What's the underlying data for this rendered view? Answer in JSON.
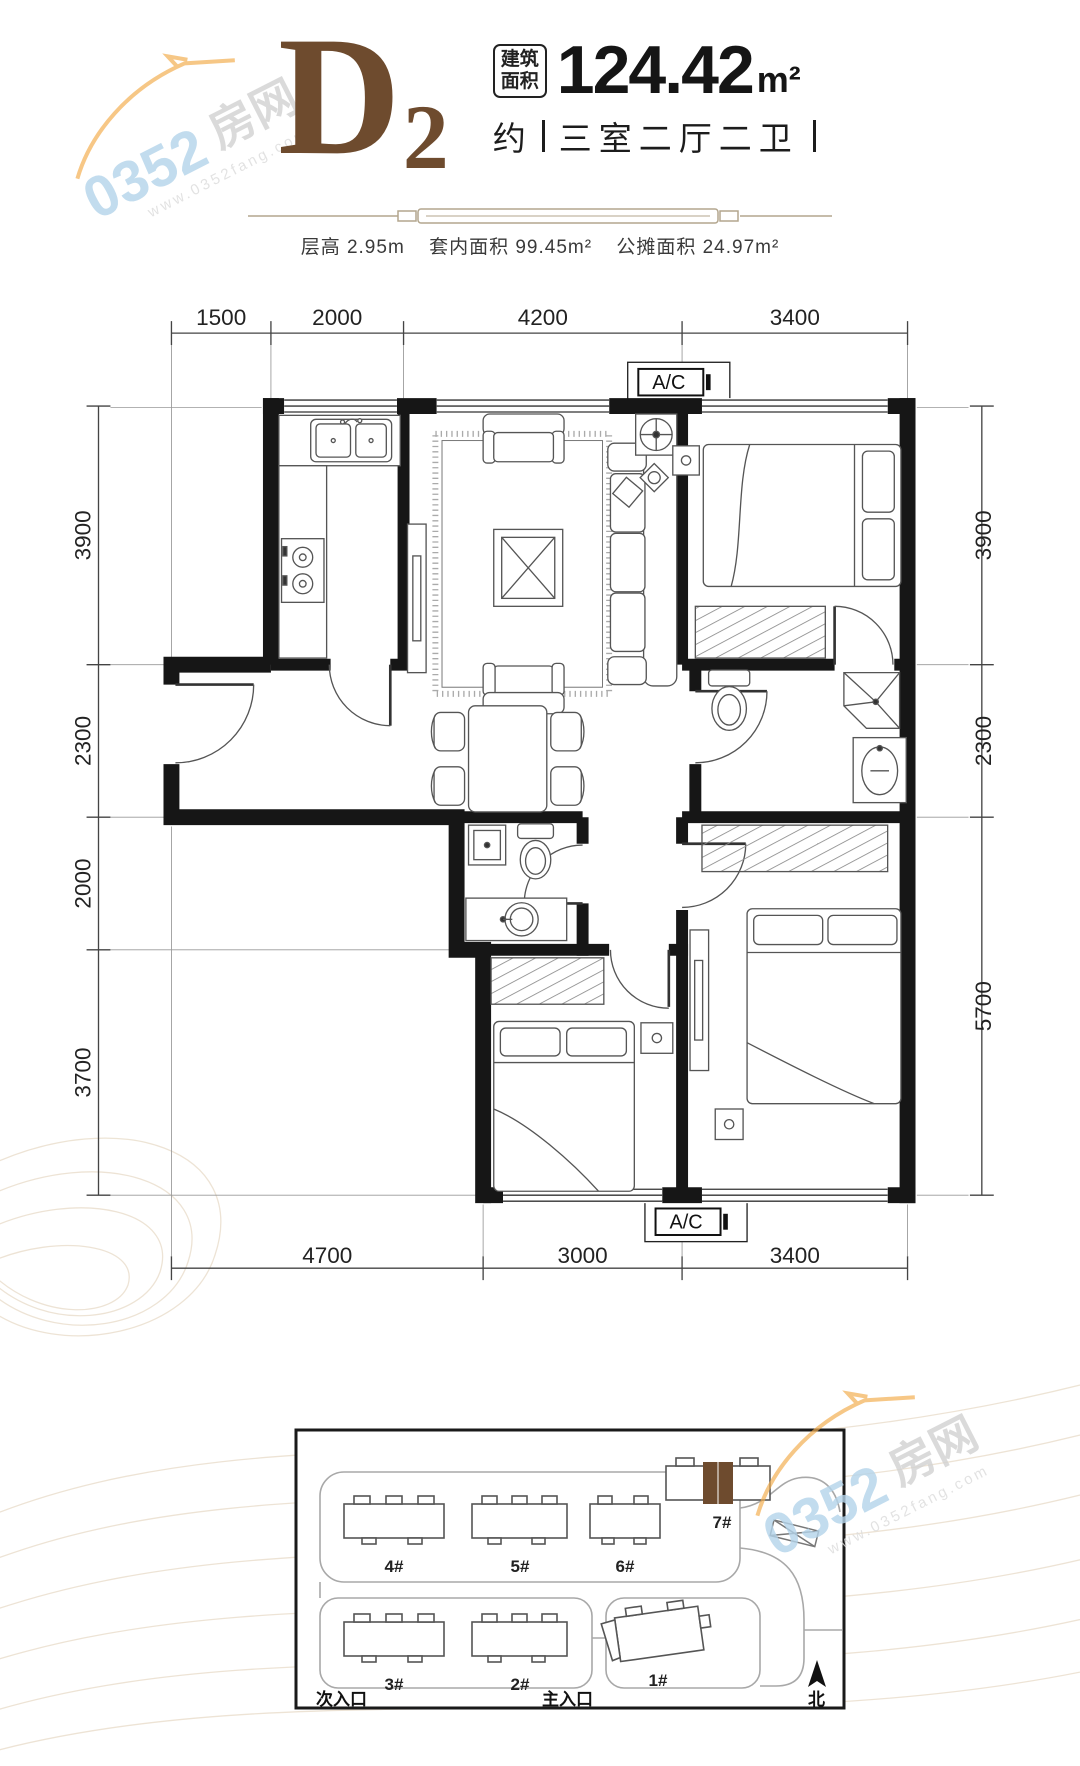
{
  "watermark": {
    "brand_number": "0352",
    "brand_suffix": "房网",
    "website": "www.0352fang.com"
  },
  "header": {
    "unit_letter": "D",
    "unit_number": "2",
    "area_label_line1": "建筑",
    "area_label_line2": "面积",
    "area_value": "124.42",
    "area_unit": "m²",
    "approx_prefix": "约",
    "layout_description": "三室二厅二卫",
    "specs": [
      "层高 2.95m",
      "套内面积 99.45m²",
      "公摊面积 24.97m²"
    ]
  },
  "floor_plan": {
    "ac_label": "A/C",
    "dimensions": {
      "top": [
        "1500",
        "2000",
        "4200",
        "3400"
      ],
      "left": [
        "3900",
        "2300",
        "2000",
        "3700"
      ],
      "right": [
        "3900",
        "2300",
        "5700"
      ],
      "bottom": [
        "4700",
        "3000",
        "3400"
      ]
    }
  },
  "site_plan": {
    "buildings": [
      "4#",
      "5#",
      "6#",
      "7#",
      "3#",
      "2#",
      "1#"
    ],
    "highlighted_building": "7#",
    "entrance_secondary": "次入口",
    "entrance_main": "主入口",
    "north": "北"
  },
  "colors": {
    "accent_brown": "#6e4b2e",
    "watermark_blue": "#b4d4ea",
    "watermark_orange": "#f3ad4e"
  }
}
